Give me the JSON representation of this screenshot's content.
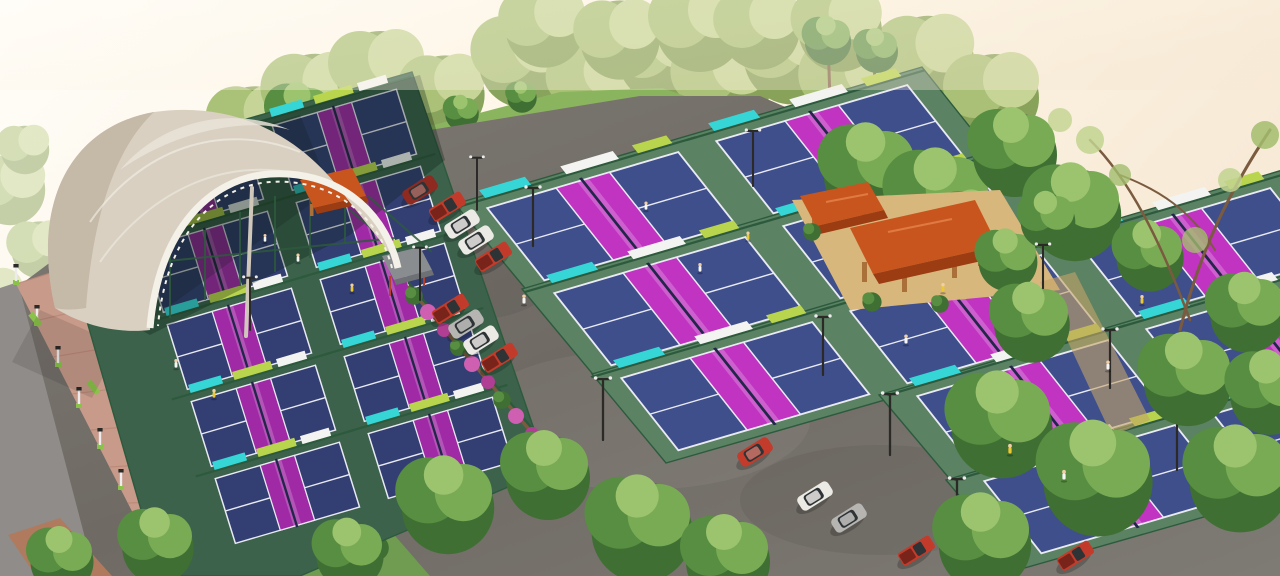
{
  "scene": {
    "title": "Aerial 3D architectural rendering of an outdoor pickleball sports complex",
    "render_type": "photorealistic isometric aerial visualization, hazy warm daylight",
    "description": "A large fabric-arch canopy arena covers courts at the left; grids of outdoor pickleball courts with navy playing surfaces and magenta kitchen zones fill the site, separated by green fencing with teal, white and lime sponsor banner boards. Diagonal parking strips hold red pickups and white, silver and dark cars. Two terracotta-roofed timber pavilions sit on a sand terrace to the northeast, a small orange gazebo and a grey-roofed shade hut flank the arena, a bougainvillea-covered fence lines the left court block, and a pink lamp-lined promenade with planters runs along the left edge. Dense trees border the site under a pale cream sky.",
    "inventory": {
      "covered_arena": 1,
      "covered_courts_visible": 4,
      "outdoor_courts_visible": 17,
      "pavilions": 2,
      "gazebo": 1,
      "shade_hut": 1,
      "parked_cars": 16,
      "street_lamps": 12,
      "flood_light_poles": 12,
      "players_on_courts": 15,
      "stairways": 1
    }
  },
  "colors": {
    "sky1": "#fffdf8",
    "sky2": "#f6e8d4",
    "sky3": "#fdf4e4",
    "canopy": "#d9d0c1",
    "canopyLight": "#e9e3d8",
    "canopyShade": "#bfb3a0",
    "truss": "#f4f1e9",
    "mast": "#cfc8ba",
    "apronC": "#5a8263",
    "apronL": "#3c624c",
    "courtBlue": "#3e4f8c",
    "courtBlueD": "#333f73",
    "kitchen": "#c133c1",
    "kitchenD": "#a02aa6",
    "lineW": "#e9eaf2",
    "net": "#23264a",
    "fence": "#2d5a3d",
    "bannerTeal": "#36d6d6",
    "bannerWhite": "#f3f4f2",
    "bannerLime": "#b9d44d",
    "asphalt": "#6f6a64",
    "asphaltL": "#7e7a74",
    "road": "#8f8c89",
    "walk": "#c79a8a",
    "walkLine": "#b98877",
    "deck": "#b07a5e",
    "lawn": "#8ab55e",
    "lawnD": "#6f9c50",
    "hedge": "#45713a",
    "tree1a": "#3f6f33",
    "tree1b": "#578e41",
    "tree1c": "#79ab55",
    "tree1d": "#9cc36e",
    "tree2a": "#7f9c4f",
    "tree2b": "#a3bd6e",
    "tree2c": "#c2d390",
    "sand": "#d8b77d",
    "sandD": "#c5a468",
    "roofO": "#c8551e",
    "roofOD": "#9c3c12",
    "roofOL": "#e07a43",
    "wood": "#a9703a",
    "carRed": "#c23b2b",
    "carRedD": "#8e2a1f",
    "carWhite": "#eceae5",
    "carSilver": "#b6b5b2",
    "carDark": "#494744",
    "window": "#2e3336",
    "pole": "#2b2a27",
    "lampWhite": "#ececec",
    "lampGreen": "#8bc34a",
    "skin": "#f0cfa6",
    "shirtYellow": "#ecc832",
    "shirtWhite": "#f6f6f4",
    "stair": "#e9e7e0",
    "flower": "#cf5fb0",
    "flowerD": "#b03f93",
    "branch": "#7a5b3f",
    "hutRoof": "#8a8d90",
    "hutFrame": "#b5402a"
  }
}
